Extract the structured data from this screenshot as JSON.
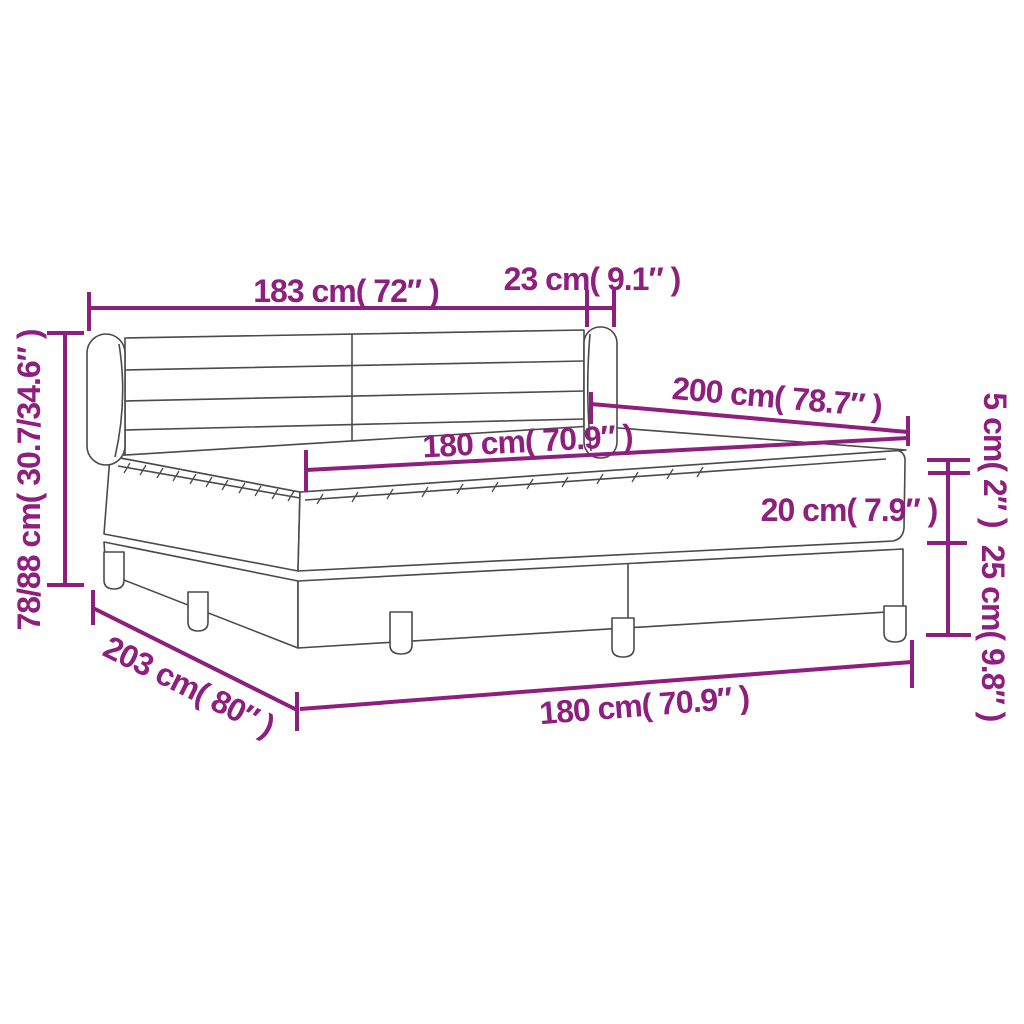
{
  "title": "Box spring bed with mattress — dimension diagram",
  "dims": {
    "headboard_width": "183 cm( 72″ )",
    "headboard_side": "23 cm( 9.1″ )",
    "height": "78/88 cm( 30.7/34.6″ )",
    "length": "200 cm( 78.7″ )",
    "mattress_width": "180 cm( 70.9″ )",
    "topper_thickness": "5 cm( 2″ )",
    "mattress_thickness": "20 cm( 7.9″ )",
    "base_height": "25 cm( 9.8″ )",
    "base_length": "203 cm( 80″ )",
    "base_width": "180 cm( 70.9″ )"
  },
  "colors": {
    "dimension_accent": "#8E1F7E",
    "line_drawing": "#4A4A4A",
    "background": "#FFFFFF"
  }
}
